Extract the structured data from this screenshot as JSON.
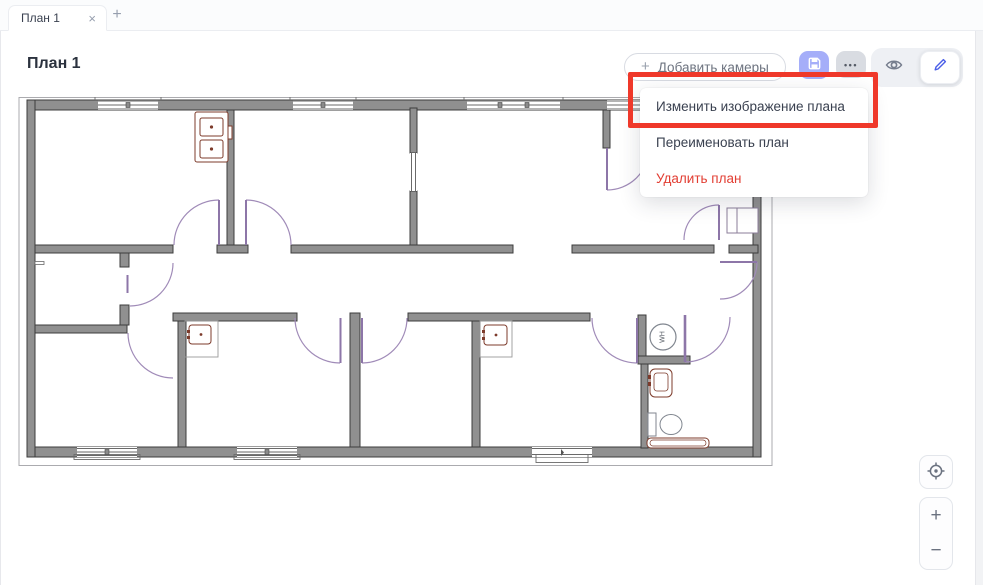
{
  "tab_bar": {
    "tab_label": "План 1",
    "close_icon": "×",
    "new_tab_icon": "+"
  },
  "header": {
    "title": "План 1"
  },
  "toolbar": {
    "add_cameras_label": "Добавить камеры",
    "plus_icon": "+",
    "more_icon": "•••",
    "save_icon": "floppy-disk",
    "view_icon": "eye",
    "edit_icon": "pencil"
  },
  "context_menu": {
    "items": [
      {
        "label": "Изменить изображение плана",
        "annotated": true
      },
      {
        "label": "Переименовать план"
      },
      {
        "label": "Удалить план",
        "danger": true
      }
    ]
  },
  "floor_plan": {
    "water_heater_label": "WH"
  },
  "map_controls": {
    "zoom_in_label": "+",
    "zoom_out_label": "−",
    "locate_icon": "crosshair"
  },
  "colors": {
    "save_button_bg": "#a5aef9",
    "edit_icon": "#4a5ee8",
    "danger_text": "#e23d32",
    "annotation_border": "#ef382a",
    "door_arc": "#a08bb8",
    "fixture_brown": "#7d3b2b"
  }
}
